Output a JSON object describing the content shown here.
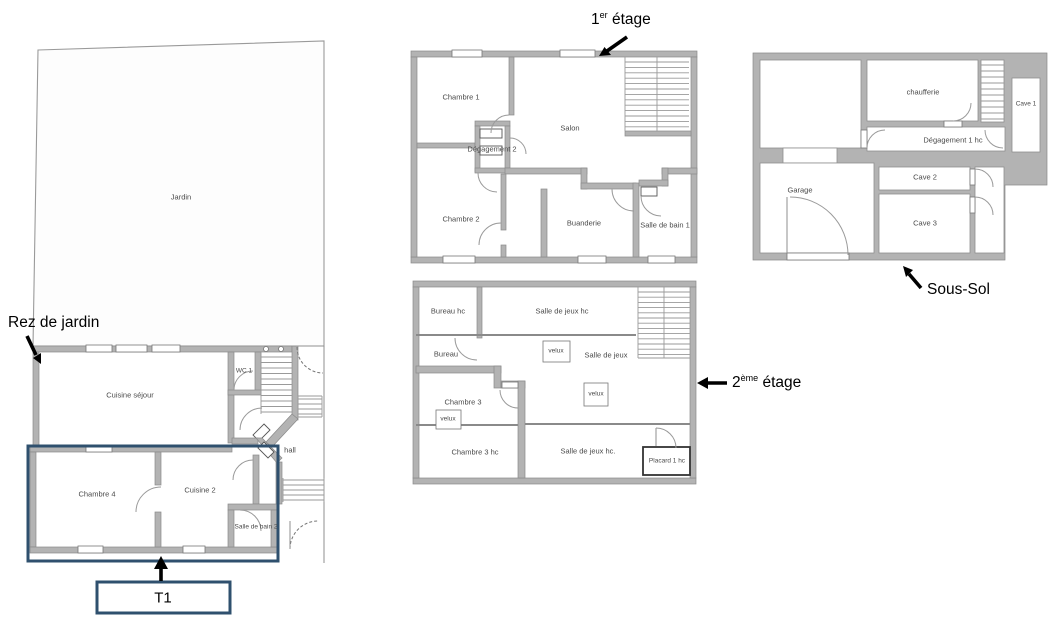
{
  "annotations": {
    "garden_level": "Rez de jardin",
    "t1": "T1",
    "first_floor": {
      "base": "1",
      "sup": "er",
      "rest": " étage"
    },
    "second_floor": {
      "base": "2",
      "sup": "ème",
      "rest": " étage"
    },
    "basement": "Sous-Sol"
  },
  "ground_floor": {
    "rooms": {
      "jardin": "Jardin",
      "cuisine_sejour": "Cuisine séjour",
      "wc1": "WC 1",
      "hall": "hall",
      "chambre4": "Chambre 4",
      "cuisine2": "Cuisine 2",
      "salle_de_bain2": "Salle de bain 2"
    }
  },
  "first_floor": {
    "rooms": {
      "chambre1": "Chambre 1",
      "salon": "Salon",
      "degagement2": "Dégagement 2",
      "chambre2": "Chambre 2",
      "buanderie": "Buanderie",
      "salle_de_bain1": "Salle de bain 1"
    }
  },
  "second_floor": {
    "rooms": {
      "bureau_hc": "Bureau hc",
      "salle_de_jeux_hc_top": "Salle de jeux hc",
      "bureau": "Bureau",
      "velux1": "velux",
      "salle_de_jeux": "Salle de jeux",
      "velux2": "velux",
      "chambre3": "Chambre 3",
      "velux3": "velux",
      "chambre3_hc": "Chambre 3 hc",
      "salle_de_jeux_hc_bottom": "Salle de jeux hc.",
      "placard1_hc": "Placard 1 hc"
    }
  },
  "basement": {
    "rooms": {
      "chaufferie": "chaufferie",
      "cave1": "Cave 1",
      "degagement1_hc": "Dégagement 1 hc",
      "garage": "Garage",
      "cave2": "Cave 2",
      "cave3": "Cave 3"
    }
  },
  "colors": {
    "highlight_blue": "#2f506e",
    "wall_gray": "#b3b3b3",
    "annotation_black": "#000000"
  }
}
